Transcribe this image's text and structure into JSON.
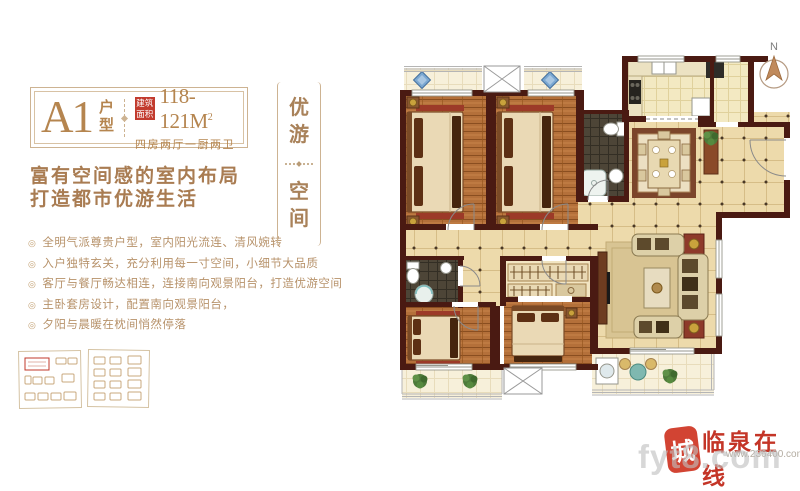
{
  "flyer": {
    "title_block": {
      "unit_code": "A1",
      "unit_label": "户型",
      "area_tag": "建筑面积",
      "area_value": "118-121M",
      "area_sup": "2",
      "layout_desc": "四房两厅一厨两卫"
    },
    "slogan": {
      "line1": "富有空间感的室内布局",
      "line2": "打造都市优游生活"
    },
    "bullet_glyph": "◎",
    "features": [
      "全明气派尊贵户型，室内阳光流连、清风婉转",
      "入户独特玄关，充分利用每一寸空间，小细节大品质",
      "客厅与餐厅畅达相连，连接南向观景阳台，打造优游空间",
      "主卧套房设计，配置南向观景阳台，",
      "夕阳与晨暖在枕间悄然停落"
    ],
    "banner": {
      "word_top": "优游",
      "word_bottom": "空间"
    },
    "compass_label": "N",
    "watermark": {
      "seal_char": "城",
      "site_name": "临泉在线",
      "site_url": "www.236400.com",
      "overlay_text": "fyt8.com"
    },
    "colors": {
      "brand_tan": "#a9825a",
      "accent_red": "#c23b2e",
      "wall": "#4a1a12",
      "wood_floor": "#b4703a",
      "tile_floor": "#eddaab"
    }
  }
}
